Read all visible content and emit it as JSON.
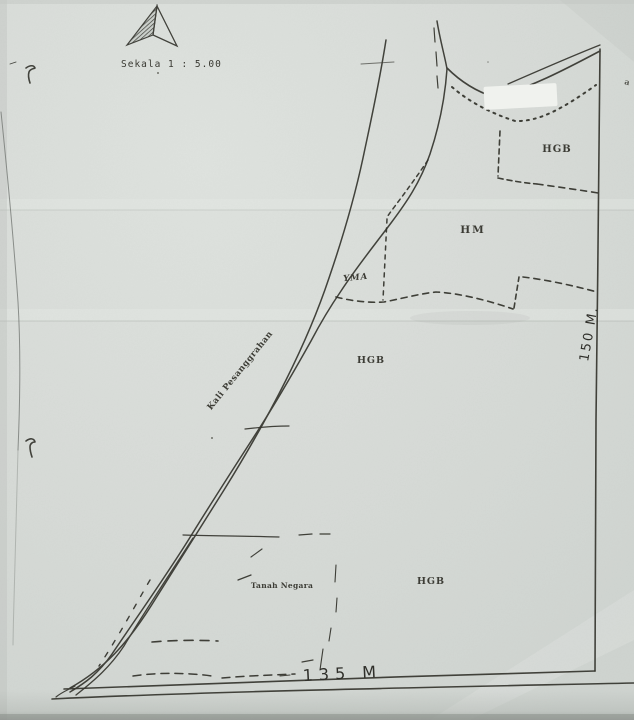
{
  "compass": {
    "icon": "north-arrow",
    "scale_label": "Sekala 1 : 5.00"
  },
  "river": {
    "label": "Kali Pesanggrahan"
  },
  "parcels": {
    "northeast": "HGB",
    "east": "HM",
    "riverside": "YMA",
    "middle": "HGB",
    "south_state_land": "Tanah Negara",
    "south": "HGB"
  },
  "measurements": {
    "right_edge": "150 M.",
    "bottom_edge": "135 M"
  },
  "stray": {
    "edge_mark": "a"
  },
  "colors": {
    "paper": "#d8dcd8",
    "ink": "#35352e",
    "redaction_patch": "#f0f2ee"
  }
}
